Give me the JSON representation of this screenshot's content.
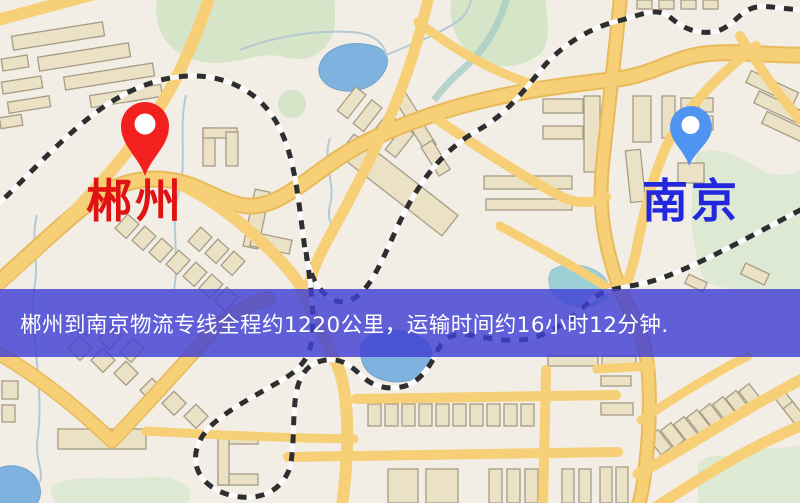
{
  "banner": {
    "text": "郴州到南京物流专线全程约1220公里，运输时间约16小时12分钟.",
    "background_color": "#3f3fd3",
    "text_color": "#ffffff"
  },
  "markers": {
    "origin": {
      "label": "郴州",
      "label_color": "#e11212",
      "pin_color": "#f32020"
    },
    "destination": {
      "label": "南京",
      "label_color": "#2327de",
      "pin_color": "#4f94f0"
    }
  },
  "route": {
    "distance_text": "约1220公里",
    "duration_text": "约16小时12分钟"
  },
  "map_palette": {
    "background": "#f2eee5",
    "road": "#f6cf76",
    "road_edge": "#e8ba5c",
    "building": "#ebe2c6",
    "park": "#d6e5c8",
    "water": "#7fb2de",
    "railway": "#2e2e2e"
  }
}
